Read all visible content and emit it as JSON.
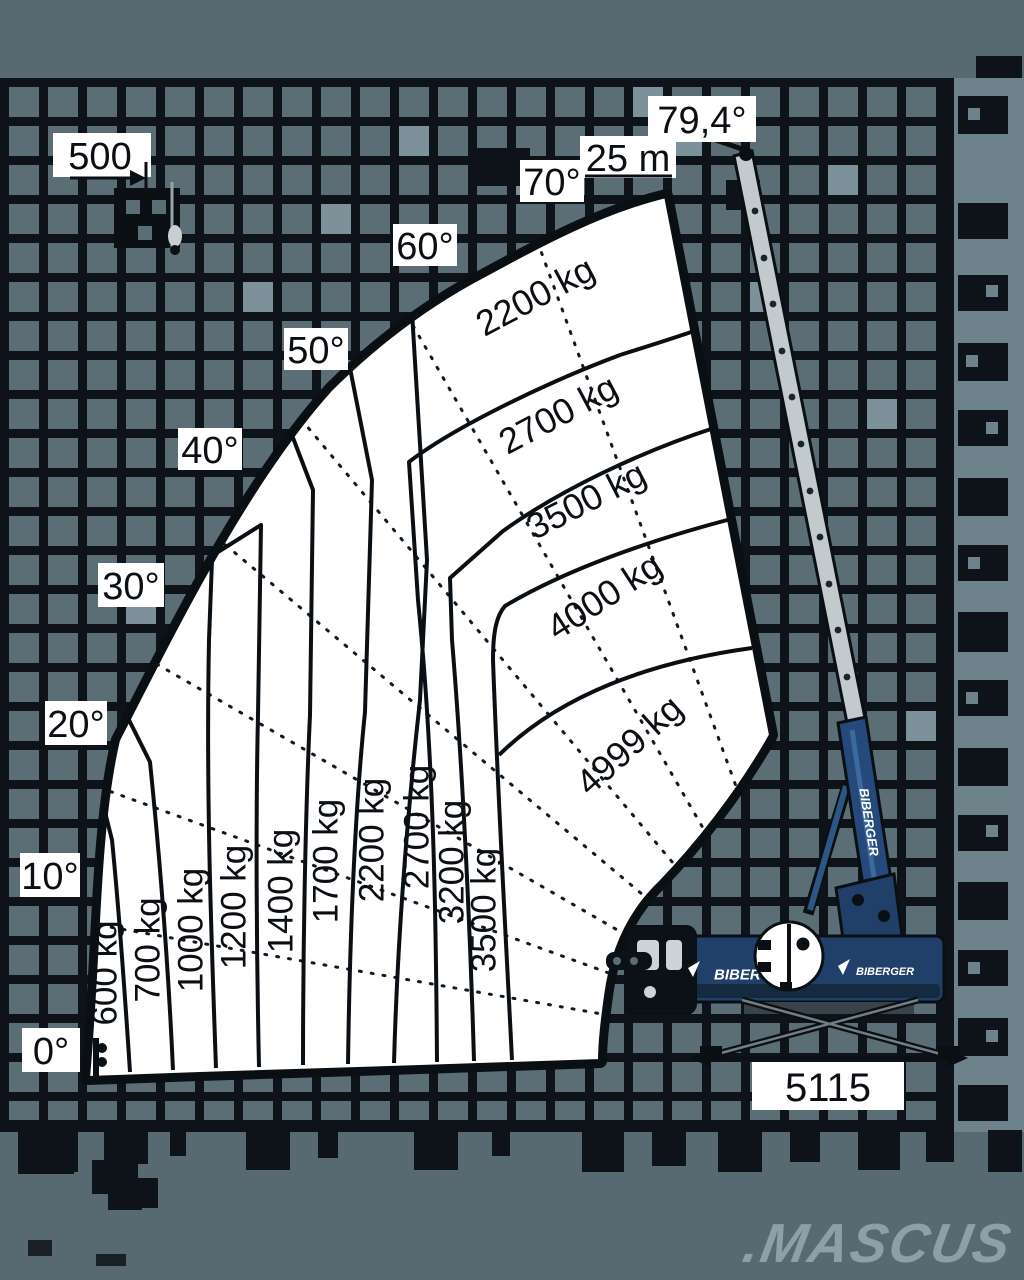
{
  "chart_data": {
    "type": "area",
    "description": "Telescopic crane working-range / load capacity diagram with boom angle rays and capacity bands",
    "angle_ticks": [
      "0°",
      "10°",
      "20°",
      "30°",
      "40°",
      "50°",
      "60°",
      "70°",
      "79,4°"
    ],
    "angle_range_deg": [
      0,
      79.4
    ],
    "max_boom_length_label": "25 m",
    "winch_label": "500",
    "outrigger_span_label": "5115",
    "outer_capacity_bands": [
      "600 kg",
      "700 kg",
      "1000 kg",
      "1200 kg",
      "1400 kg",
      "1700 kg",
      "2200 kg",
      "2700 kg",
      "3200 kg",
      "3500 kg"
    ],
    "inner_capacity_zones": [
      "2200 kg",
      "2700 kg",
      "3500 kg",
      "4000 kg",
      "4999 kg"
    ],
    "max_capacity_kg": 4999,
    "grid": true,
    "legend_position": "none"
  },
  "crane": {
    "brand": "BIBERGER",
    "boom_decal": "BIBERGER",
    "body_decal_left": "BIBER",
    "body_decal_right": "BIBERGER"
  },
  "watermark": ".MASCUS",
  "colors": {
    "background": "#576a72",
    "grid_line": "#0d1318",
    "grid_cell": "#5b6e76",
    "fan_fill": "#ffffff",
    "line": "#0a0f14",
    "crane_blue": "#20406a",
    "boom_gray": "#c3cacd",
    "right_strip": "#6e828b",
    "watermark_gray": "#8ba0a7"
  }
}
